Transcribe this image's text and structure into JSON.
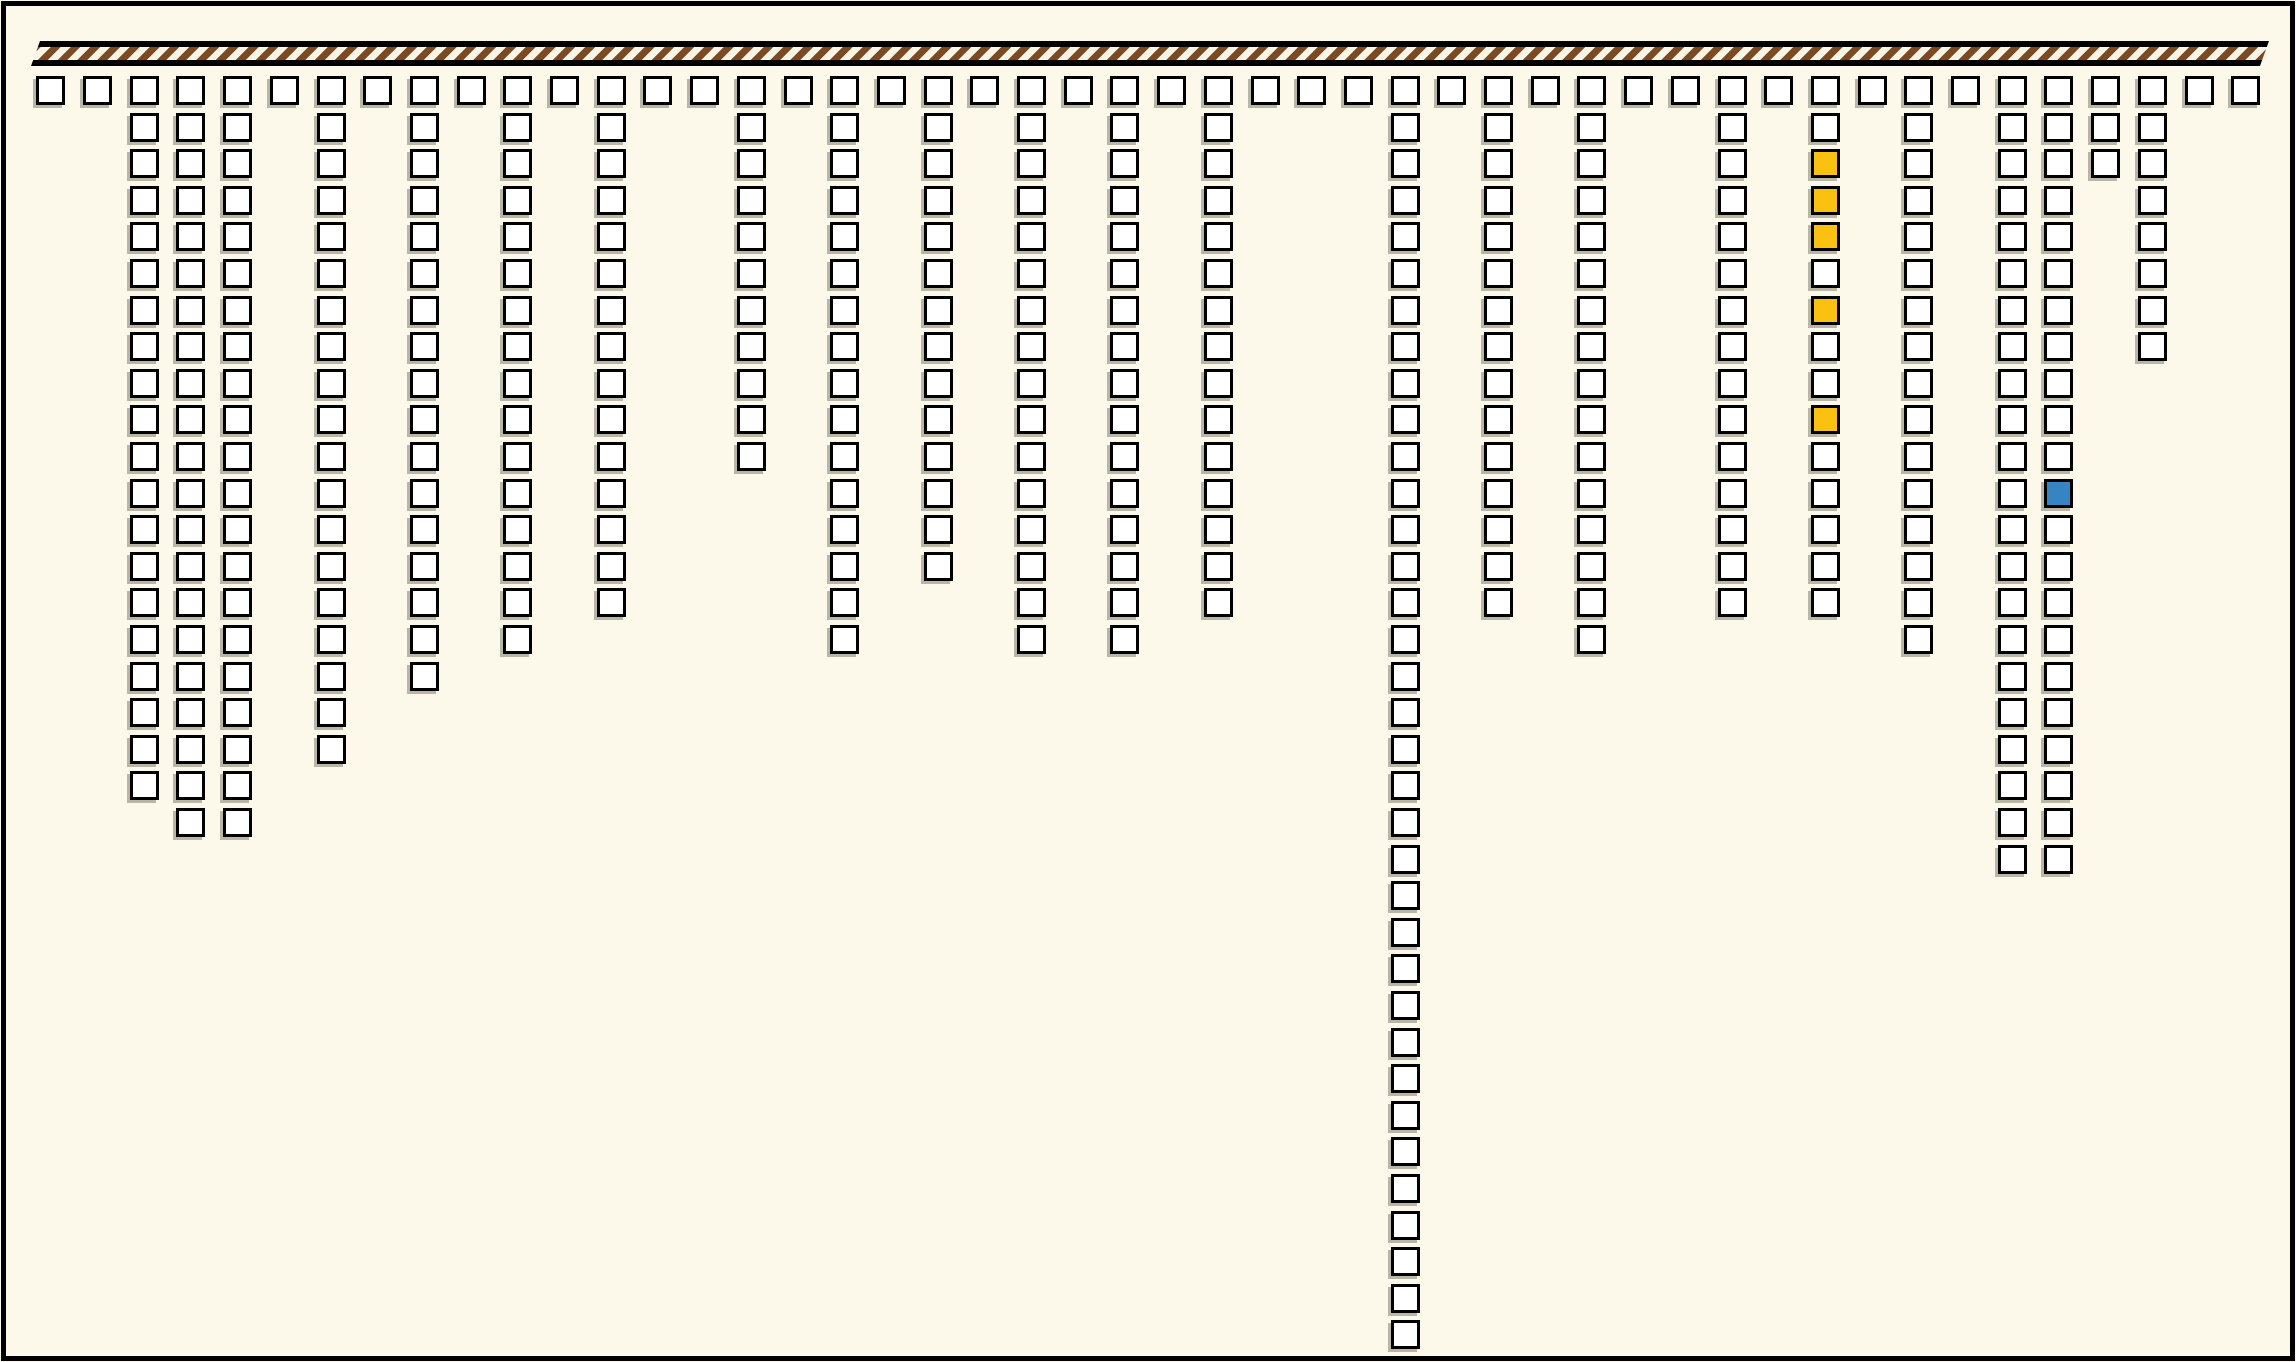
{
  "canvas": {
    "background": "#FCF9EB",
    "frame_color": "#000000"
  },
  "hatched_bar": {
    "x": 31,
    "y": 41,
    "width": 2238,
    "height": 25,
    "edge_color": "#000000",
    "stripe_dark": "#7B4A22",
    "stripe_light": "#F9F5E6",
    "slant_px": 9
  },
  "chart_data": {
    "type": "icon-array-columns",
    "title": null,
    "xlabel": null,
    "ylabel": null,
    "legend": null,
    "description": "48 columns of black-outlined square tokens hang downward from a hatched top bar; every column has a square in the top row, and column k stacks values[k] squares total with no gaps.",
    "num_columns": 48,
    "num_rows_max": 35,
    "values": [
      1,
      1,
      20,
      21,
      21,
      1,
      19,
      1,
      17,
      1,
      16,
      1,
      15,
      1,
      1,
      11,
      1,
      16,
      1,
      14,
      1,
      16,
      1,
      16,
      1,
      15,
      1,
      1,
      1,
      35,
      1,
      15,
      1,
      16,
      1,
      1,
      15,
      1,
      15,
      1,
      16,
      1,
      22,
      22,
      3,
      8,
      1,
      1
    ],
    "highlights": [
      {
        "column": 39,
        "rows": [
          3,
          4,
          5,
          7,
          10
        ],
        "color": "#FBC110",
        "name": "yellow-cells"
      },
      {
        "column": 44,
        "rows": [
          12
        ],
        "color": "#3684C1",
        "name": "blue-cell"
      }
    ],
    "cell": {
      "fill": "#FFFFFF",
      "stroke": "#000000",
      "shadow": "rgba(60,55,40,0.35)"
    }
  }
}
